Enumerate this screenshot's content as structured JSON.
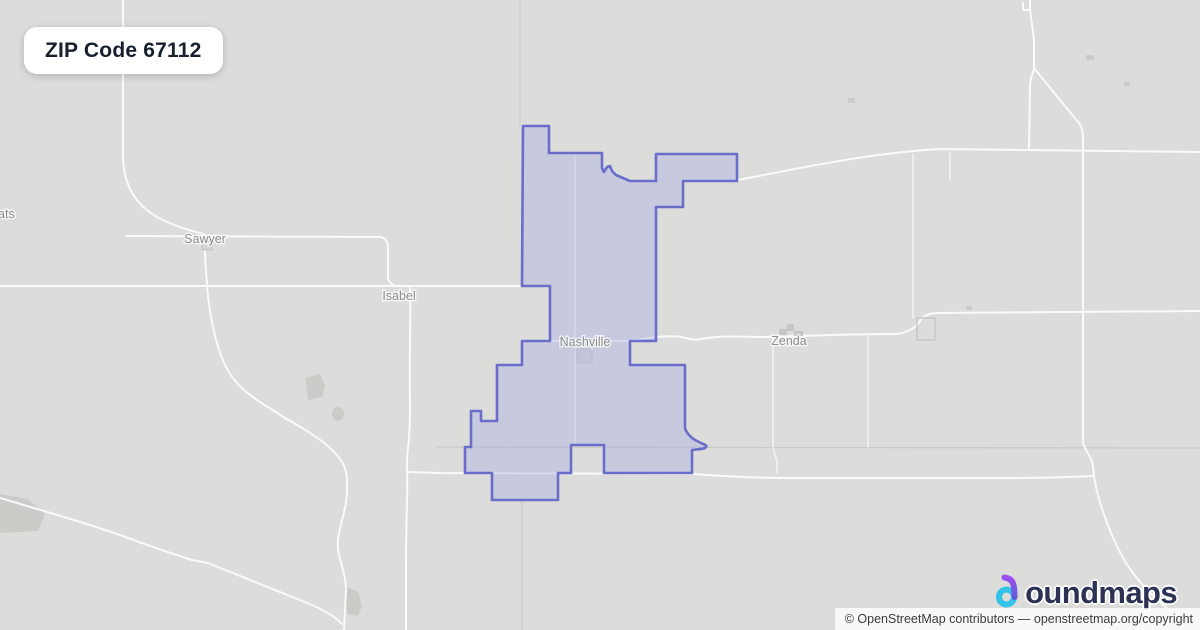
{
  "badge": {
    "label": "ZIP Code 67112"
  },
  "map_labels": {
    "sawyer": "Sawyer",
    "isabel": "Isabel",
    "nashville": "Nashville",
    "zenda": "Zenda",
    "left_edge_partial": "ats"
  },
  "colors": {
    "map_background": "#dcdcdb",
    "road": "#fafaf9",
    "admin_line": "#c9c9c8",
    "zip_fill": "#a9b0e4",
    "zip_border": "#6a6dca",
    "town_label": "#8f8f8f",
    "badge_text": "#16202e",
    "logo_text": "#2d3254",
    "logo_b_purple": "#9b4ff0",
    "logo_b_cyan": "#33c3e8"
  },
  "logo": {
    "brand": "boundmaps",
    "wordmark_rest": "oundmaps"
  },
  "attribution": {
    "text": "© OpenStreetMap contributors — openstreetmap.org/copyright"
  }
}
